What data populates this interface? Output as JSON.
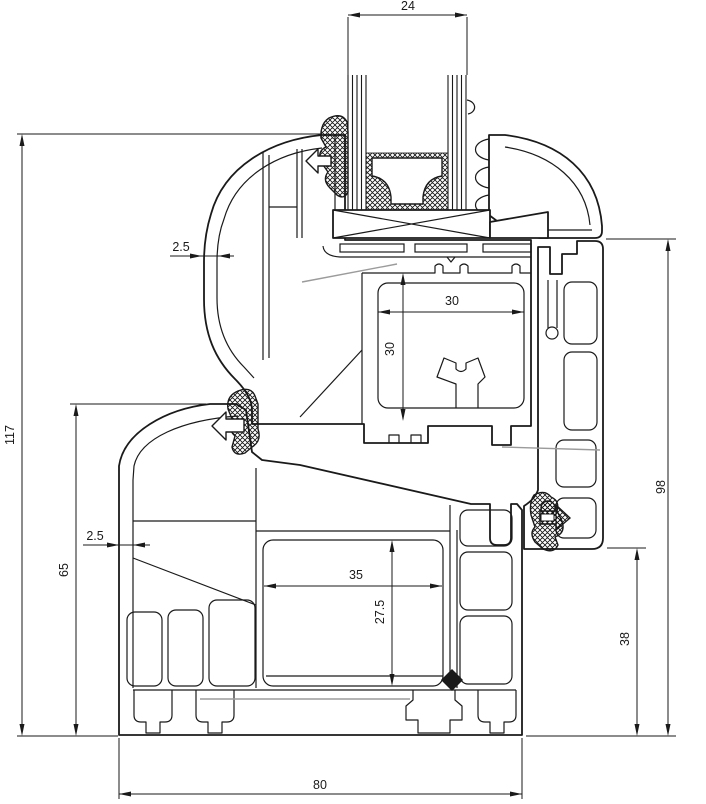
{
  "drawing": {
    "type": "window-frame-profile-cross-section",
    "background": "#ffffff",
    "line_color": "#1a1a1a",
    "secondary_line_color": "#9b9b9b",
    "dimensions": [
      {
        "id": "glazing-width",
        "value": "24"
      },
      {
        "id": "sash-wall-thickness",
        "value": "2.5"
      },
      {
        "id": "overall-height",
        "value": "117"
      },
      {
        "id": "frame-height",
        "value": "65"
      },
      {
        "id": "frame-wall-thickness",
        "value": "2.5"
      },
      {
        "id": "sash-chamber-width",
        "value": "30"
      },
      {
        "id": "sash-chamber-height",
        "value": "30"
      },
      {
        "id": "frame-chamber-width",
        "value": "35"
      },
      {
        "id": "frame-chamber-height",
        "value": "27.5"
      },
      {
        "id": "frame-outer-height",
        "value": "98"
      },
      {
        "id": "frame-lower-height",
        "value": "38"
      },
      {
        "id": "frame-width",
        "value": "80"
      }
    ]
  }
}
